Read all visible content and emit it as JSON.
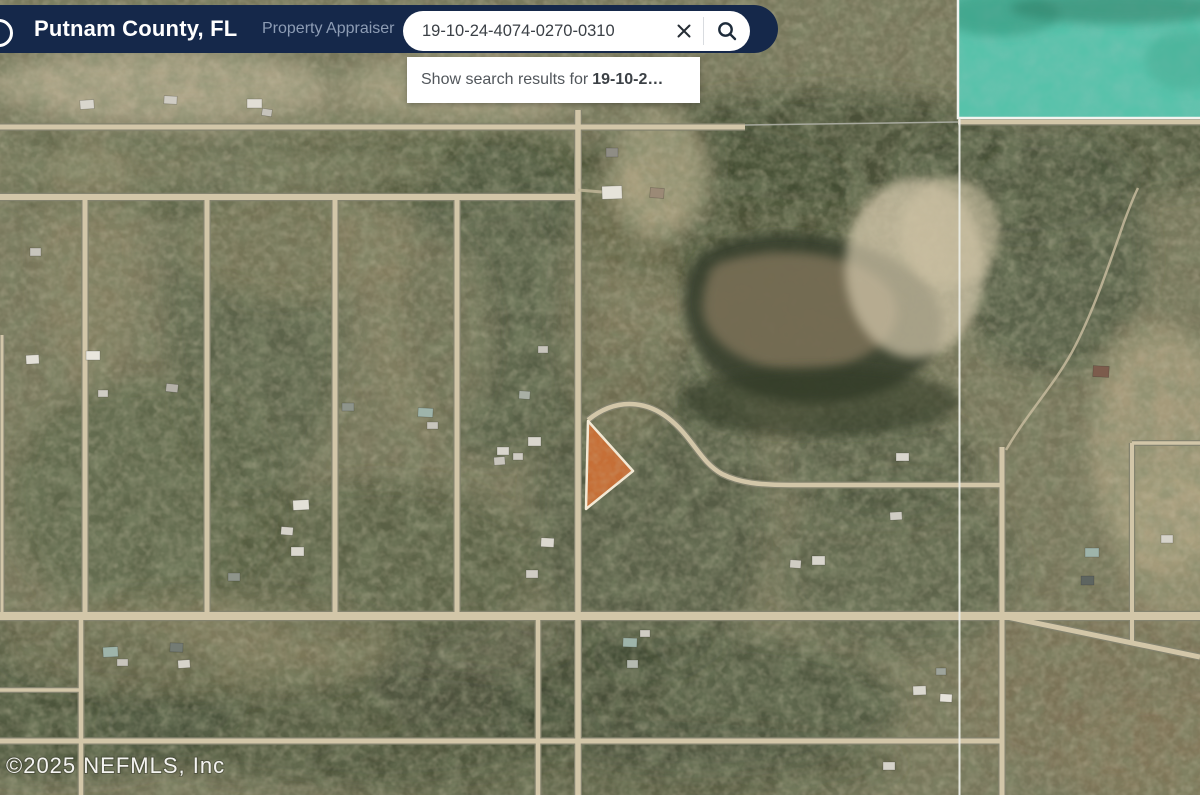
{
  "header": {
    "title": "Putnam County, FL",
    "subtitle": "Property Appraiser",
    "bar_color": "#15284A",
    "search": {
      "value": "19-10-24-4074-0270-0310",
      "clear_icon": "x-icon",
      "search_icon": "magnifier-icon"
    }
  },
  "suggestion": {
    "prefix": "Show search results for",
    "query": "19-10-2…"
  },
  "map": {
    "type": "aerial-imagery",
    "attribution": "©2025 NEFMLS, Inc",
    "selected_parcel_color": "#CB7036",
    "selected_parcel_border": "#F4EAD6",
    "water_overlay_color": "#57C2AA",
    "road_color": "#D2C6A8",
    "boundary_line_color": "#ECEEE8"
  }
}
